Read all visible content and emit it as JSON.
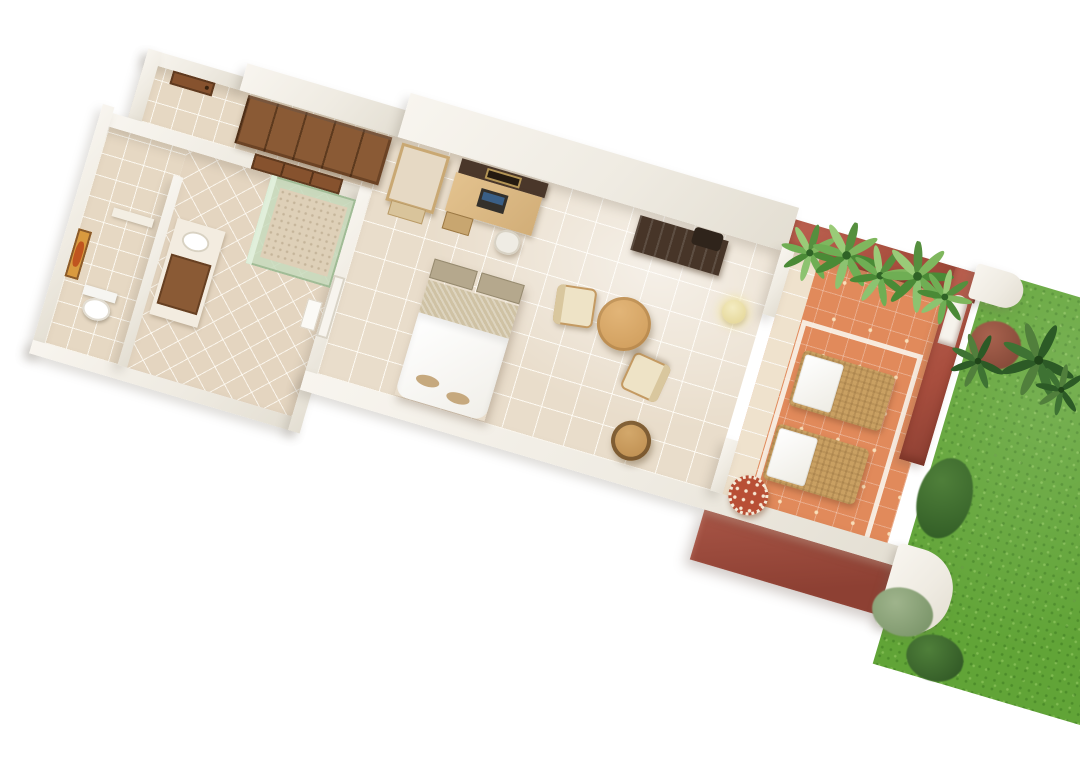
{
  "scene": {
    "kind": "3d-floor-plan-render",
    "subject": "hotel guest room floor plan with entry corridor, wc, bathroom, bedroom, furnished terrace and garden lawn",
    "rotation_deg": 16.5,
    "background": "#ffffff"
  },
  "palette": {
    "wall_white": "#f2efe9",
    "wall_shade": "#e3ded2",
    "floor_tile": "#e9ddcb",
    "bath_tile": "#e4d5c0",
    "wood_door": "#7c4c28",
    "wardrobe": "#8a5a35",
    "tv_frame": "#4a372a",
    "desk_wood": "#d9b887",
    "bed_white": "#fdfdfc",
    "bed_band": "#cfc2a4",
    "headboard": "#b5a88d",
    "terrace_tile": "#e18a5b",
    "terrace_wall_red": "#a84e3e",
    "grass_green": "#61a437",
    "palm_green": "#5f9c44",
    "lamp_cream": "#ece0a9",
    "mosaic_red": "#b84f35"
  },
  "rooms": [
    {
      "name": "entry-corridor"
    },
    {
      "name": "wc"
    },
    {
      "name": "bathroom"
    },
    {
      "name": "bedroom"
    },
    {
      "name": "terrace"
    },
    {
      "name": "garden"
    }
  ],
  "furniture": [
    "entry-door",
    "wardrobe",
    "sliding-bath-door",
    "vanity",
    "sink",
    "shower",
    "toilet",
    "wall-art",
    "mirror-stand",
    "tv-panel",
    "desk",
    "laptop",
    "desk-stool",
    "luggage-console",
    "dining-table",
    "dining-chair",
    "dining-chair",
    "floor-lamp",
    "round-stool",
    "double-bed",
    "slippers",
    "sun-lounger",
    "sun-lounger",
    "mosaic-table",
    "planter-palms",
    "garden-bushes"
  ]
}
